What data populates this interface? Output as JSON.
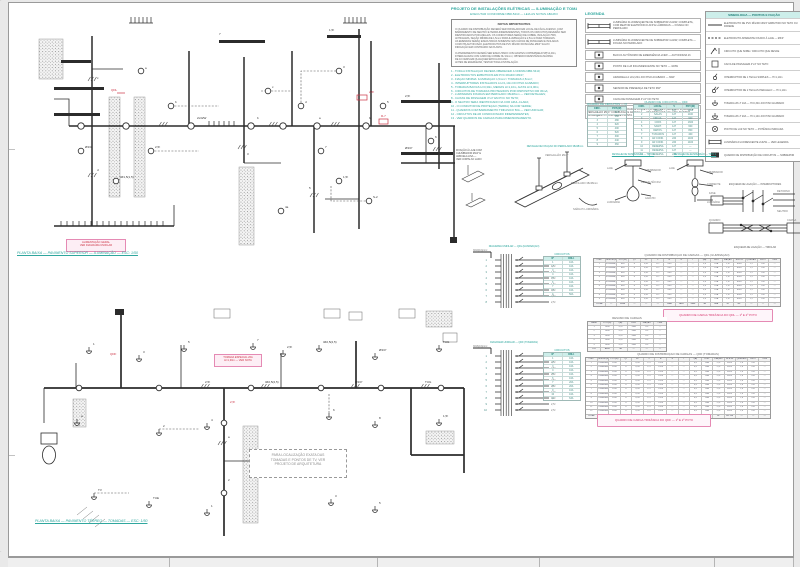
{
  "accent": {
    "teal": "#2fa79e",
    "mint": "#cdeeea",
    "pink": "#e58ab4",
    "magenta": "#d6336c",
    "red": "#cc3344",
    "ink": "#2b2b2b"
  },
  "notes": {
    "header1": "PROJETO DE INSTALAÇÕES ELÉTRICAS — ILUMINAÇÃO E TOMADAS",
    "header2": "EXECUTAR CONFORME NBR-5410 — LEIA AS NOTAS ABAIXO",
    "box_heading": "NOTAS IMPORTANTES",
    "paragraph1": [
      "O QUADRO DE DISTRIBUIÇÃO DEVERÁ SER INSTALADO EM LOCAL DE FÁCIL ACESSO, COM",
      "BARRAMENTO DE NEUTRO E TERRA INDEPENDENTES. TODOS OS CIRCUITOS DEVERÃO SER",
      "IDENTIFICADOS POR ANILHAS. OS CONDUTORES SERÃO DE COBRE, ISOLAÇÃO 750V,",
      "ANTICHAMA, SEÇÃO MÍNIMA DE 1,5mm² PARA ILUMINAÇÃO E 2,5mm² PARA TOMADAS.",
      "AS EMENDAS SERÃO EXECUTADAS SOMENTE NAS CAIXAS DE PASSAGEM E ISOLADAS",
      "COM FITA AUTOFUSÃO. ELETRODUTOS DE PVC RÍGIDO ROSCÁVEL Ø3/4\" SALVO",
      "INDICAÇÃO EM CONTRÁRIO NA PLANTA."
    ],
    "paragraph2": [
      "O ATERRAMENTO DEVERÁ SER EXECUTADO COM HASTES COPPERWELD 5/8\"x2,40m,",
      "INTERLIGADAS COM CABO DE COBRE NU 16mm², OBTENDO RESISTÊNCIA MÁXIMA",
      "DE 10 OHMS EM QUALQUER ÉPOCA DO ANO.",
      "ANTES DE ENERGIZAR, TESTAR TODA A INSTALAÇÃO."
    ],
    "items": [
      "1 - TODA A INSTALAÇÃO DEVERÁ OBEDECER À NORMA NBR-5410;",
      "2 - ELETRODUTOS EMBUTIDOS EM PVC RÍGIDO Ø3/4\";",
      "3 - FIAÇÃO MÍNIMA: ILUMINAÇÃO 1,5mm² / TOMADAS 2,5mm²;",
      "4 - INTERRUPTORES INSTALADOS A H=1,10m DO PISO ACABADO;",
      "5 - TOMADAS BAIXAS H=0,30m, MÉDIAS H=1,10m, ALTAS H=2,00m;",
      "6 - CIRCUITOS DE TOMADAS PROTEGIDOS POR DISPOSITIVO DR 30mA;",
      "7 - LUMINÁRIAS FIXADAS EM PERFILADO 38x38mm — VER DETALHES;",
      "8 - CAIXAS DE PASSAGEM 4\"x4\" EM PVC NO TETO;",
      "9 - O NEUTRO SERÁ IDENTIFICADO NA COR AZUL-CLARA;",
      "10 - O CONDUTOR DE PROTEÇÃO (TERRA) NA COR VERDE;",
      "11 - QUADROS COM BARRAMENTO TRIFÁSICO 50A — VER UNIFILAR;",
      "12 - CIRCUITOS DE AR CONDICIONADO INDEPENDENTES;",
      "13 - VER QUADROS DE CARGAS PARA DIMENSIONAMENTO."
    ]
  },
  "legend_mid": {
    "title": "LEGENDA",
    "fixture_rows": [
      {
        "tag": "2x32W",
        "desc": "LUMINÁRIA FLUORESCENTE DE SOBREPOR 2x32W, COMPLETA, COM REATOR ELETRÔNICO AFP E LÂMPADAS — FIXADA NO PERFILADO"
      },
      {
        "tag": "1x32W",
        "desc": "LUMINÁRIA FLUORESCENTE DE SOBREPOR 1x32W, COMPLETA — FIXADA NO PERFILADO"
      }
    ],
    "rows": [
      {
        "desc": "BLOCO AUTÔNOMO DE EMERGÊNCIA 2x9W — AUTONOMIA 1h"
      },
      {
        "desc": "PONTO DE LUZ INCANDESCENTE NO TETO — 100W"
      },
      {
        "desc": "ARANDELA A H=2,20m DO PISO ACABADO — 60W"
      },
      {
        "desc": "SENSOR DE PRESENÇA DE TETO 360°"
      },
      {
        "desc": "CAIXA DE PASSAGEM 4\"x4\" NO TETO"
      }
    ],
    "note": "OBS.: AS LUMINÁRIAS SERÃO FIXADAS À LAJE POR MEIO DE PERFILADO 38x38mm E VERGALHÃO Ø1/4\" COM BUCHA E ARRUELA — VER DETALHES AO LADO. MANTER ALINHAMENTO CONFORME PLANTA.",
    "table_a": {
      "title": "QUADRO DE CIRCUITOS — QDL",
      "headers": [
        "CIRC.",
        "POT.(W)"
      ],
      "rows": [
        [
          "1",
          "640"
        ],
        [
          "2",
          "560"
        ],
        [
          "3",
          "480"
        ],
        [
          "4",
          "620"
        ],
        [
          "5",
          "400"
        ],
        [
          "6",
          "520"
        ],
        [
          "7",
          "300"
        ],
        [
          "8",
          "440"
        ],
        [
          "9",
          "360"
        ]
      ]
    },
    "table_b": {
      "title": "QUADRO DE CIRCUITOS — QDF",
      "headers": [
        "CIRC.",
        "LOCAL",
        "V",
        "POT.(W)"
      ],
      "rows": [
        [
          "1",
          "SALAS",
          "127",
          "1200"
        ],
        [
          "2",
          "SALAS",
          "127",
          "1100"
        ],
        [
          "3",
          "CIRCUL.",
          "127",
          "900"
        ],
        [
          "4",
          "COPA",
          "127",
          "1300"
        ],
        [
          "5",
          "SANIT.",
          "127",
          "600"
        ],
        [
          "6",
          "DEPÓS.",
          "127",
          "800"
        ],
        [
          "7",
          "TV/DADOS",
          "127",
          "400"
        ],
        [
          "8",
          "AR COND.",
          "220",
          "1400"
        ],
        [
          "9",
          "AR COND.",
          "220",
          "1400"
        ],
        [
          "10",
          "RESERVA",
          "127",
          "—"
        ],
        [
          "11",
          "RESERVA",
          "127",
          "—"
        ],
        [
          "12",
          "RESERVA",
          "220",
          "—"
        ]
      ]
    }
  },
  "legend_right": {
    "title": "SIMBOLOGIA — PONTOS E FIAÇÃO",
    "rows": [
      {
        "sym": "conduit",
        "desc": "ELETRODUTO DE PVC RÍGIDO Ø3/4\" EMBUTIDO NO TETO OU PAREDE"
      },
      {
        "sym": "conduit-dash",
        "desc": "ELETRODUTO APARENTE FIXADO À LAJE — Ø3/4\""
      },
      {
        "sym": "rise",
        "desc": "CIRCUITO QUE SOBE / CIRCUITO QUE DESCE"
      },
      {
        "sym": "box",
        "desc": "CAIXA DE PASSAGEM 4\"x4\" NO TETO"
      },
      {
        "sym": "switch1",
        "desc": "INTERRUPTOR DE 1 TECLA SIMPLES — H=1,10m"
      },
      {
        "sym": "switch2",
        "desc": "INTERRUPTOR DE 2 TECLAS PARALELO — H=1,10m"
      },
      {
        "sym": "outlet-low",
        "desc": "TOMADA 2P+T 10A — H=0,30m DO PISO ACABADO"
      },
      {
        "sym": "outlet-high",
        "desc": "TOMADA 2P+T 20A — H=1,10m DO PISO ACABADO"
      },
      {
        "sym": "light",
        "desc": "PONTO DE LUZ NO TETO — POTÊNCIA INDICADA"
      },
      {
        "sym": "lum",
        "desc": "LUMINÁRIA FLUORESCENTE 2x32W — VER LEGENDA"
      },
      {
        "sym": "qd",
        "desc": "QUADRO DE DISTRIBUIÇÃO DE CIRCUITOS — SOBREPOR"
      }
    ],
    "diagram1_label": "ESQUEMA DE LIGAÇÃO — INTERRUPTORES",
    "diagram2_label": "ESQUEMA DE LIGAÇÃO — TRIFILAR",
    "diagram1_notes": [
      "FASE",
      "RETORNO",
      "NEUTRO"
    ],
    "diagram2_notes": [
      "QUADRO",
      "CARGA"
    ]
  },
  "details": {
    "d1_lines": [
      "FIXAÇÃO À LAJE COM",
      "CHUMBADOR Ø1/4\" E",
      "ARRUELA LISA —",
      "VER CORTE AO LADO"
    ],
    "d2_title": "DETALHE DE FIXAÇÃO DO PERFILADO 38x38mm",
    "d2_labels": [
      "VERGALHÃO Ø1/4\"",
      "PERFILADO 38x38mm",
      "SAÍDA P/ LUMINÁRIA"
    ],
    "d3_title": "DETALHE DE SUSPENSÃO — TIPO 1",
    "d3_labels": [
      "LAJE",
      "CHUMBADOR",
      "VERGALHÃO Ø1/4\"",
      "GANCHO",
      "LUMINÁRIA"
    ],
    "d4_title": "DETALHE DE SUSPENSÃO — TIPO 2",
    "d4_labels": [
      "LAJE",
      "CHUMBADOR",
      "CORRENTE",
      "LUMINÁRIA"
    ]
  },
  "risers": {
    "r1": {
      "title": "DIAGRAMA UNIFILAR — QDL (ILUMINAÇÃO)",
      "feeder": "3#10(10)mm²",
      "left": [
        "1",
        "2",
        "3",
        "4",
        "5",
        "6",
        "7",
        "8"
      ],
      "right": [
        "1,5²",
        "1,5²",
        "1,5²",
        "1,5²",
        "1,5²",
        "1,5²",
        "2,5²",
        "2,5²"
      ]
    },
    "r2": {
      "title": "DIAGRAMA UNIFILAR — QDF (TOMADAS)",
      "feeder": "3#16(16)mm²",
      "left": [
        "1",
        "2",
        "3",
        "4",
        "5",
        "6",
        "7",
        "8",
        "9",
        "10"
      ],
      "right": [
        "2,5²",
        "2,5²",
        "2,5²",
        "2,5²",
        "2,5²",
        "2,5²",
        "4,0²",
        "4,0²",
        "2,5²",
        "2,5²"
      ]
    }
  },
  "side_tables": {
    "s1": {
      "title": "CIRCUITOS",
      "headers": [
        "Nº",
        "DISJ."
      ],
      "rows": [
        [
          "1",
          "10A"
        ],
        [
          "2",
          "10A"
        ],
        [
          "3",
          "10A"
        ],
        [
          "4",
          "10A"
        ],
        [
          "5",
          "10A"
        ],
        [
          "6",
          "10A"
        ],
        [
          "7",
          "16A"
        ],
        [
          "8",
          "16A"
        ],
        [
          "G",
          "50A"
        ]
      ]
    },
    "s2": {
      "title": "CIRCUITOS",
      "headers": [
        "Nº",
        "DISJ."
      ],
      "rows": [
        [
          "1",
          "16A"
        ],
        [
          "2",
          "16A"
        ],
        [
          "3",
          "16A"
        ],
        [
          "4",
          "16A"
        ],
        [
          "5",
          "16A"
        ],
        [
          "6",
          "16A"
        ],
        [
          "7",
          "20A"
        ],
        [
          "8",
          "20A"
        ],
        [
          "9",
          "16A"
        ],
        [
          "10",
          "16A"
        ],
        [
          "G",
          "63A"
        ]
      ]
    }
  },
  "tables": {
    "t1": {
      "title": "QUADRO DE DISTRIBUIÇÃO DE CARGAS — QDL (ILUMINAÇÃO)",
      "headers": [
        "CIRC",
        "DESCRIÇÃO",
        "POT(W)",
        "QT",
        "FP",
        "V",
        "R",
        "S",
        "T",
        "I(A)",
        "DISJ",
        "FIAÇÃO",
        "ELETR.",
        "QUEDA%",
        "PROT",
        "OBS"
      ],
      "sample": [
        "1",
        "ILUMINAÇÃO",
        "640",
        "8",
        "0,92",
        "127",
        "640",
        "—",
        "—",
        "5,0",
        "10A",
        "1,5²",
        "Ø3/4\"",
        "1,2",
        "DR",
        "—"
      ],
      "nrows": 9,
      "footer": [
        "TOTAL",
        "—",
        "4320",
        "—",
        "—",
        "—",
        "1480",
        "1420",
        "1420",
        "34",
        "50A",
        "10²",
        "Ø1\"",
        "—",
        "—",
        "—"
      ]
    },
    "t2": {
      "title": "RESUMO DE CARGAS",
      "headers": [
        "FASE",
        "POT(W)",
        "I(A)",
        "DISJ",
        "FIAÇÃO",
        "OBS"
      ],
      "sample": [
        "R",
        "1480",
        "11,6",
        "50A",
        "10²",
        "—"
      ],
      "nrows": 5,
      "footer": [
        "TOT",
        "4320",
        "34",
        "—",
        "—",
        "—"
      ]
    },
    "t3": {
      "title": "QUADRO DE DISTRIBUIÇÃO DE CARGAS — QDF (TOMADAS)",
      "headers": [
        "CIRC",
        "DESCRIÇÃO",
        "POT(W)",
        "QT",
        "FP",
        "V",
        "R",
        "S",
        "T",
        "I(A)",
        "DISJ",
        "FIAÇÃO",
        "ELETR.",
        "QUEDA%",
        "PROT",
        "OBS"
      ],
      "sample": [
        "1",
        "TOMADAS 2P+T",
        "1200",
        "6",
        "0,95",
        "127",
        "1200",
        "—",
        "—",
        "9,4",
        "16A",
        "2,5²",
        "Ø3/4\"",
        "1,6",
        "DR",
        "—"
      ],
      "nrows": 12,
      "footer": [
        "TOTAL",
        "—",
        "10100",
        "—",
        "—",
        "—",
        "3400",
        "3350",
        "3350",
        "80",
        "63A",
        "16²",
        "Ø1.1/4\"",
        "—",
        "—",
        "—"
      ]
    },
    "l1": "QUADRO DE CARGA TRIFÁSICA DO QDL — 1º E 2º PVTO",
    "l2": "QUADRO DE CARGA TRIFÁSICA DO QDF — 1º E 2º PVTO"
  },
  "plan_top": {
    "title": "PLANTA BAIXA — PAVIMENTO SUPERIOR — ILUMINAÇÃO — ESC: 1/50",
    "pink_box": [
      "ALIMENTAÇÃO GERAL",
      "VER DIAGRAMA UNIFILAR"
    ],
    "labels": [
      "a",
      "b",
      "c",
      "d",
      "3",
      "5",
      "7",
      "1,5²",
      "2,5²",
      "Ø3/4\"",
      "3#1,5(1,5)",
      "S-2",
      "4a",
      "6",
      "2x32W",
      "b"
    ],
    "red_labels": [
      "QDL",
      "2,5²",
      "R-7"
    ]
  },
  "plan_bottom": {
    "title": "PLANTA BAIXA — PAVIMENTO TÉRREO — TOMADAS — ESC: 1/50",
    "pink_box": [
      "TOMADA ESPECIAL 20A",
      "H=1,30m — VER NOTA"
    ],
    "note_box": [
      "PARA LOCALIZAÇÃO EXATA DAS",
      "TOMADAS E PONTOS DE TV, VER",
      "PROJETO DE ARQUITETURA"
    ],
    "labels": [
      "1",
      "3",
      "5",
      "7",
      "2,5²",
      "3#2,5(2,5)",
      "Ø3/4\"",
      "TUG",
      "a",
      "2",
      "4",
      "6",
      "8",
      "1,5²",
      "TV",
      "TUE"
    ],
    "red_labels": [
      "QDF",
      "2,5²"
    ]
  }
}
